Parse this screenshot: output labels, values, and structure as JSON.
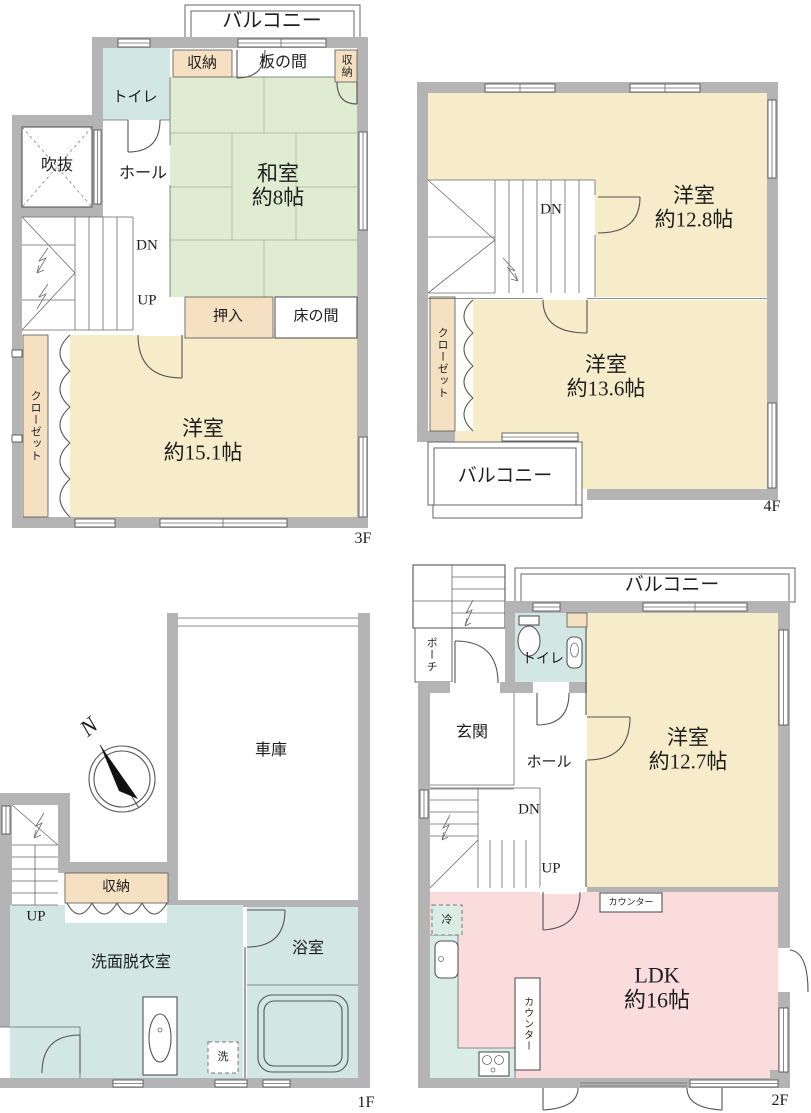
{
  "colors": {
    "wall": "#b4b4b4",
    "tatami": "#e0ecd2",
    "western": "#f6ecca",
    "storage": "#f5e0c1",
    "water": "#d2e7e3",
    "kitchen": "#d9ece5",
    "ldk": "#fadcdc",
    "line": "#555555"
  },
  "floors": {
    "f3": {
      "floor_label": "3F",
      "balcony": "バルコニー",
      "toilet": "トイレ",
      "storage_top": "収納",
      "itanoma": "板の間",
      "storage_right": "収納",
      "washitsu_name": "和室",
      "washitsu_size": "約8帖",
      "fukinuke": "吹抜",
      "hall": "ホール",
      "dn": "DN",
      "up": "UP",
      "oshiire": "押入",
      "tokonoma": "床の間",
      "closet": "クローゼット",
      "yoshitsu_name": "洋室",
      "yoshitsu_size": "約15.1帖"
    },
    "f4": {
      "floor_label": "4F",
      "room1_name": "洋室",
      "room1_size": "約12.8帖",
      "dn": "DN",
      "closet": "クローゼット",
      "room2_name": "洋室",
      "room2_size": "約13.6帖",
      "balcony": "バルコニー"
    },
    "f1": {
      "floor_label": "1F",
      "garage": "車庫",
      "compass_n": "N",
      "up": "UP",
      "storage": "収納",
      "washroom": "洗面脱衣室",
      "bathroom": "浴室",
      "washer": "洗"
    },
    "f2": {
      "floor_label": "2F",
      "balcony": "バルコニー",
      "porch": "ポーチ",
      "toilet": "トイレ",
      "entrance": "玄関",
      "hall": "ホール",
      "dn": "DN",
      "up": "UP",
      "room_name": "洋室",
      "room_size": "約12.7帖",
      "counter_top": "カウンター",
      "counter_side": "カウンター",
      "fridge": "冷",
      "ldk_name": "LDK",
      "ldk_size": "約16帖"
    }
  }
}
